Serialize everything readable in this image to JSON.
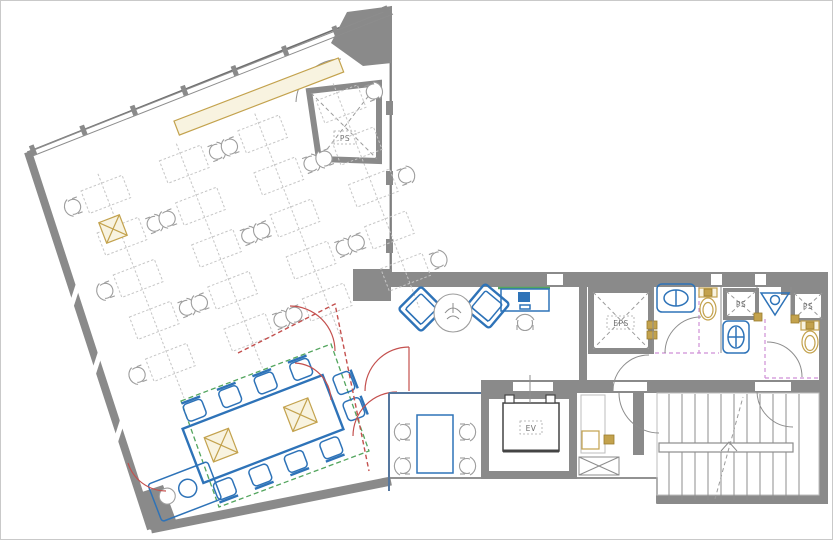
{
  "drawing": {
    "type": "architectural-floor-plan",
    "labels": {
      "ps_top": "PS",
      "eps": "EPS",
      "ev": "EV",
      "ps_right_a": "PS",
      "ps_right_b": "PS"
    }
  },
  "colors": {
    "wall": "#8a8a8a",
    "line": "#6f6f6f",
    "desk": "#c6c6c6",
    "chair": "#9d9d9d",
    "blue": "#2e73b8",
    "red": "#c4504e",
    "green": "#53a55e",
    "magenta": "#cf8fd6",
    "tan": "#c3a24d",
    "tan_light": "#f8f3e0"
  },
  "office": {
    "grid": {
      "cols": 4,
      "rows": 5
    },
    "rotation": -21,
    "origin": {
      "x": 80,
      "y": 190
    },
    "col_pitch": 84,
    "row_pitch": 45,
    "desk": {
      "w": 44,
      "h": 24
    }
  },
  "meeting_room": {
    "chair_count": 10
  },
  "small_room": {
    "chair_count": 4
  },
  "lounge": {
    "armchair_count": 2
  },
  "stairs": {
    "tread_count": 11
  },
  "windows": {
    "top_edge_posts": 8,
    "left_edge_gaps": 3
  }
}
